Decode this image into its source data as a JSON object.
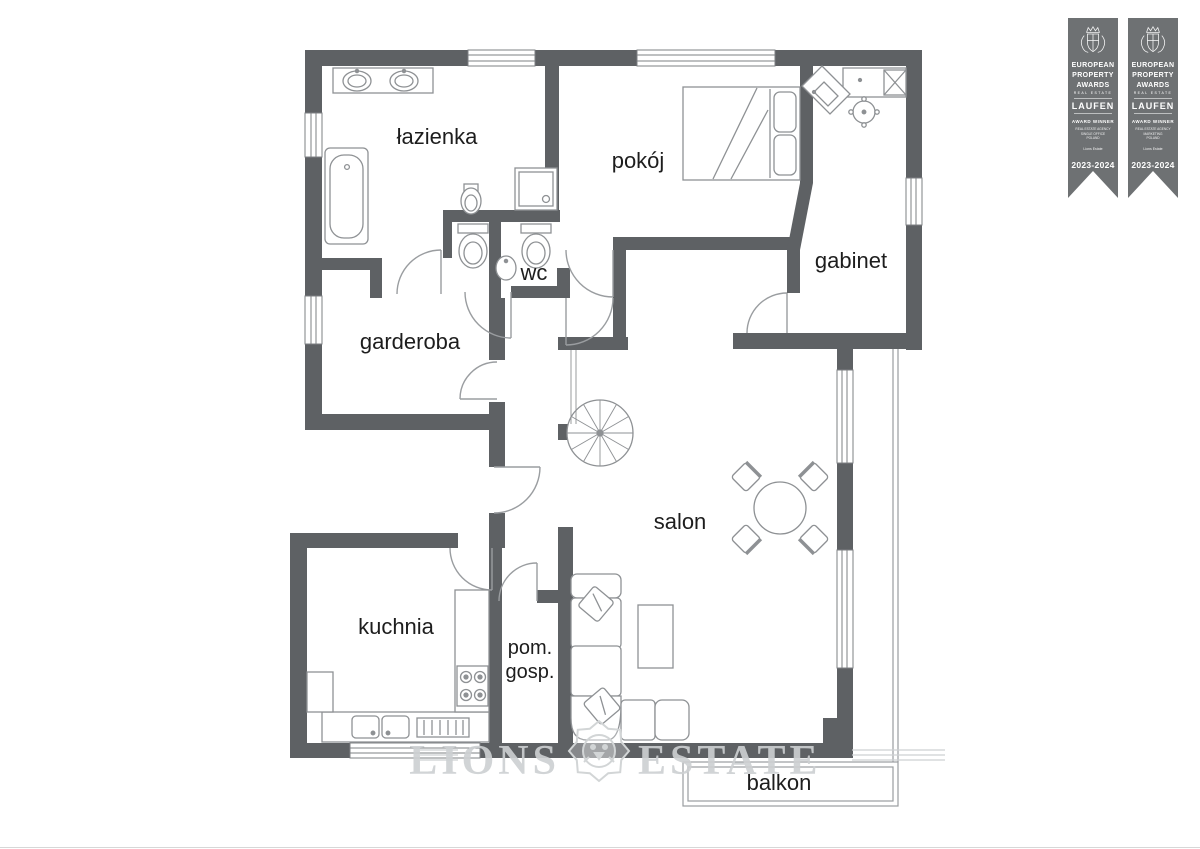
{
  "plan": {
    "rooms": [
      {
        "name": "lazienka",
        "label": "łazienka"
      },
      {
        "name": "pokoj",
        "label": "pokój"
      },
      {
        "name": "gabinet",
        "label": "gabinet"
      },
      {
        "name": "garderoba",
        "label": "garderoba"
      },
      {
        "name": "wc",
        "label": "wc"
      },
      {
        "name": "salon",
        "label": "salon"
      },
      {
        "name": "kuchnia",
        "label": "kuchnia"
      },
      {
        "name": "pom-gosp",
        "label_line1": "pom.",
        "label_line2": "gosp."
      },
      {
        "name": "balkon",
        "label": "balkon"
      }
    ]
  },
  "watermark": {
    "brand_left": "LIONS",
    "brand_right": "ESTATE",
    "icon": "lion-head"
  },
  "awards": {
    "badges": [
      {
        "org": [
          "EUROPEAN",
          "PROPERTY",
          "AWARDS"
        ],
        "org_sub": "REAL ESTATE",
        "sponsor": "LAUFEN",
        "winner": "AWARD WINNER",
        "category": [
          "REAL ESTATE AGENCY",
          "SINGLE OFFICE",
          "POLAND"
        ],
        "recipient": "Lions Estate",
        "years": "2023-2024"
      },
      {
        "org": [
          "EUROPEAN",
          "PROPERTY",
          "AWARDS"
        ],
        "org_sub": "REAL ESTATE",
        "sponsor": "LAUFEN",
        "winner": "AWARD WINNER",
        "category": [
          "REAL ESTATE AGENCY",
          "MARKETING",
          "POLAND"
        ],
        "recipient": "Lions Estate",
        "years": "2023-2024"
      }
    ]
  },
  "colors": {
    "wall": "#5e6164",
    "fixture_stroke": "#8e9194",
    "door_stroke": "#9a9da0",
    "label": "#1d1d1d",
    "watermark": "#cdd0d2",
    "badge_bg": "#6e7173"
  }
}
